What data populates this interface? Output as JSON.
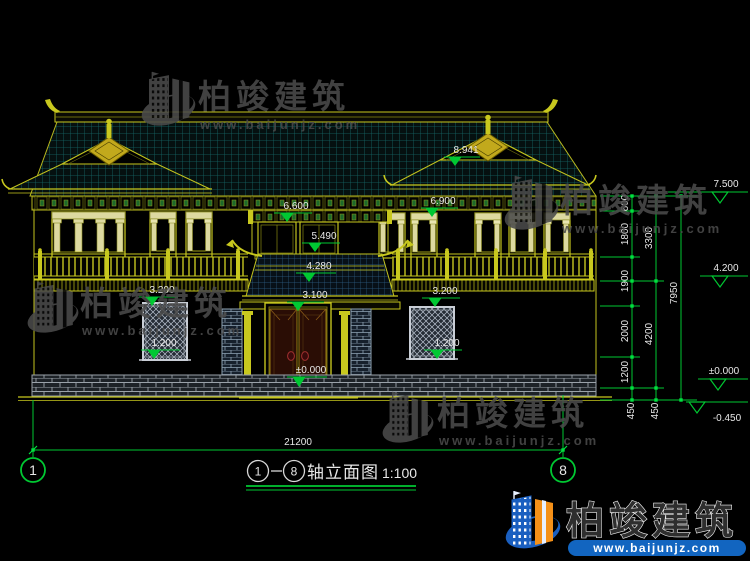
{
  "watermark": {
    "brand": "柏竣建筑",
    "site": "www.baijunjz.com"
  },
  "footer_logo": {
    "brand": "柏竣建筑",
    "site": "www.baijunjz.com"
  },
  "title_bar": {
    "axis_start": "1",
    "axis_end": "8",
    "name": "轴立面图",
    "scale": "1:100"
  },
  "axis_bubbles": {
    "left": "1",
    "right": "8"
  },
  "dimensions": {
    "total_width": "21200",
    "col1": [
      "600",
      "1800",
      "1900",
      "2000",
      "1200",
      "450"
    ],
    "col2": [
      "3300",
      "4200",
      "450"
    ],
    "col3": [
      "7950"
    ]
  },
  "levels": {
    "parapet": "7.500",
    "balcony": "4.200",
    "zero_right": "±0.000",
    "foundation": "-0.450",
    "gable_ridge": "8.941",
    "eave_right": "6.900",
    "eave_center": "6.600",
    "center_sill": "5.490",
    "porch_eave": "4.280",
    "door_head": "3.100",
    "zero_entrance": "±0.000",
    "win_head_left": "3.200",
    "win_sill_left": "1.200",
    "win_head_right": "3.200",
    "win_sill_right": "1.200"
  },
  "colors": {
    "background": "#000000",
    "line_yellow": "#c3c31e",
    "dim_green": "#00c832",
    "text_white": "#e8e8e8",
    "tile_teal": "#156868",
    "watermark_gray": "#4b4b4b",
    "logo_blue": "#1a5fc0",
    "logo_orange": "#f49018"
  }
}
